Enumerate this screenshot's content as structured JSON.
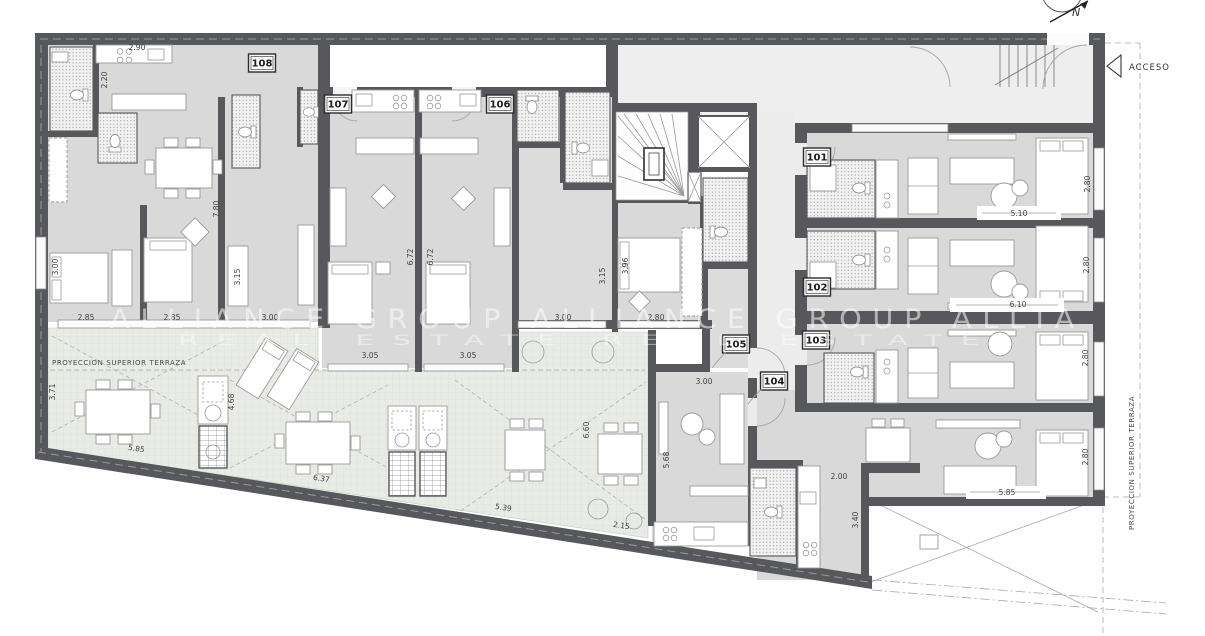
{
  "drawing": {
    "compass_label": "N",
    "access_label": "ACCESO",
    "projection_label_left": "PROYECCION SUPERIOR TERRAZA",
    "projection_label_right": "PROYECCION SUPERIOR TERRAZA",
    "watermark": {
      "line1": "ALLIANCE GROUP ALLIANCE GROUP ALLIA",
      "line2": "REAL ESTATE            REAL ESTATE"
    }
  },
  "room_badges": [
    {
      "label": "108",
      "x": 262,
      "y": 63
    },
    {
      "label": "107",
      "x": 338,
      "y": 104
    },
    {
      "label": "106",
      "x": 500,
      "y": 104
    },
    {
      "label": "105",
      "x": 736,
      "y": 344
    },
    {
      "label": "104",
      "x": 774,
      "y": 381
    },
    {
      "label": "103",
      "x": 816,
      "y": 340
    },
    {
      "label": "102",
      "x": 817,
      "y": 287
    },
    {
      "label": "101",
      "x": 817,
      "y": 157
    }
  ],
  "dimensions": [
    {
      "t": "2.90",
      "x": 137,
      "y": 50,
      "r": 0
    },
    {
      "t": "2.20",
      "x": 107,
      "y": 80,
      "r": -90
    },
    {
      "t": "3.00",
      "x": 58,
      "y": 267,
      "r": -90
    },
    {
      "t": "7.80",
      "x": 219,
      "y": 209,
      "r": -90
    },
    {
      "t": "3.15",
      "x": 240,
      "y": 277,
      "r": -90
    },
    {
      "t": "2.85",
      "x": 86,
      "y": 320,
      "r": 0
    },
    {
      "t": "2.85",
      "x": 172,
      "y": 320,
      "r": 0
    },
    {
      "t": "3.00",
      "x": 270,
      "y": 320,
      "r": 0
    },
    {
      "t": "3.05",
      "x": 370,
      "y": 358,
      "r": 0
    },
    {
      "t": "3.05",
      "x": 468,
      "y": 358,
      "r": 0
    },
    {
      "t": "3.00",
      "x": 563,
      "y": 320,
      "r": 0
    },
    {
      "t": "2.80",
      "x": 656,
      "y": 320,
      "r": 0
    },
    {
      "t": "6.72",
      "x": 413,
      "y": 257,
      "r": -90
    },
    {
      "t": "6.72",
      "x": 433,
      "y": 257,
      "r": -90
    },
    {
      "t": "3.15",
      "x": 605,
      "y": 276,
      "r": -90
    },
    {
      "t": "3.96",
      "x": 628,
      "y": 266,
      "r": -90
    },
    {
      "t": "3.71",
      "x": 55,
      "y": 392,
      "r": -90
    },
    {
      "t": "4.68",
      "x": 234,
      "y": 402,
      "r": -90
    },
    {
      "t": "5.85",
      "x": 136,
      "y": 451,
      "r": 9
    },
    {
      "t": "6.37",
      "x": 321,
      "y": 481,
      "r": 9
    },
    {
      "t": "5.39",
      "x": 503,
      "y": 510,
      "r": 9
    },
    {
      "t": "2.15",
      "x": 621,
      "y": 528,
      "r": 9
    },
    {
      "t": "6.60",
      "x": 589,
      "y": 430,
      "r": -90
    },
    {
      "t": "5.68",
      "x": 669,
      "y": 460,
      "r": -90
    },
    {
      "t": "3.00",
      "x": 704,
      "y": 384,
      "r": 0
    },
    {
      "t": "2.00",
      "x": 839,
      "y": 479,
      "r": 0
    },
    {
      "t": "3.40",
      "x": 858,
      "y": 520,
      "r": -90
    },
    {
      "t": "5.10",
      "x": 1019,
      "y": 216,
      "r": 0
    },
    {
      "t": "6.10",
      "x": 1018,
      "y": 307,
      "r": 0
    },
    {
      "t": "5.85",
      "x": 1007,
      "y": 495,
      "r": 0
    },
    {
      "t": "2.80",
      "x": 1090,
      "y": 184,
      "r": -90
    },
    {
      "t": "2.80",
      "x": 1089,
      "y": 265,
      "r": -90
    },
    {
      "t": "2.80",
      "x": 1088,
      "y": 358,
      "r": -90
    },
    {
      "t": "2.80",
      "x": 1088,
      "y": 457,
      "r": -90
    }
  ]
}
